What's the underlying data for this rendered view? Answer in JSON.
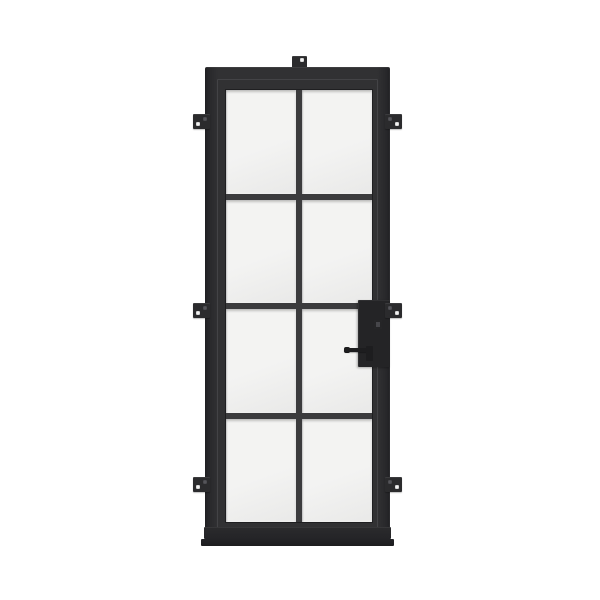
{
  "scene": {
    "background_color": "#ffffff",
    "subject": "single-steel-french-door-product-render"
  },
  "door": {
    "colors": {
      "frame": "#313133",
      "frame_edge": "#242427",
      "frame_highlight": "#55555a",
      "muntin": "#3b3b3d",
      "glass": "#f3f3f2",
      "glass_shade": "#e9e9e8",
      "hardware": "#1d1d1f",
      "lockbox": "#242426",
      "tab": "#2b2b2d",
      "hole_light": "#f2f2f2",
      "hole_dark": "#55555a",
      "sill": "#2b2b2d"
    },
    "glass_grid": {
      "columns": 2,
      "rows": 4,
      "pane_count": 8
    },
    "mounting": {
      "top_bracket_count": 1,
      "left_tab_count": 3,
      "right_tab_count": 3,
      "tab_tops_y": [
        114,
        303,
        477
      ],
      "left_tabs_x": 193,
      "right_tabs_x": 385
    },
    "hardware": {
      "handle_side": "right",
      "lever_handle": true,
      "deadbolt_lockbox": true
    }
  }
}
